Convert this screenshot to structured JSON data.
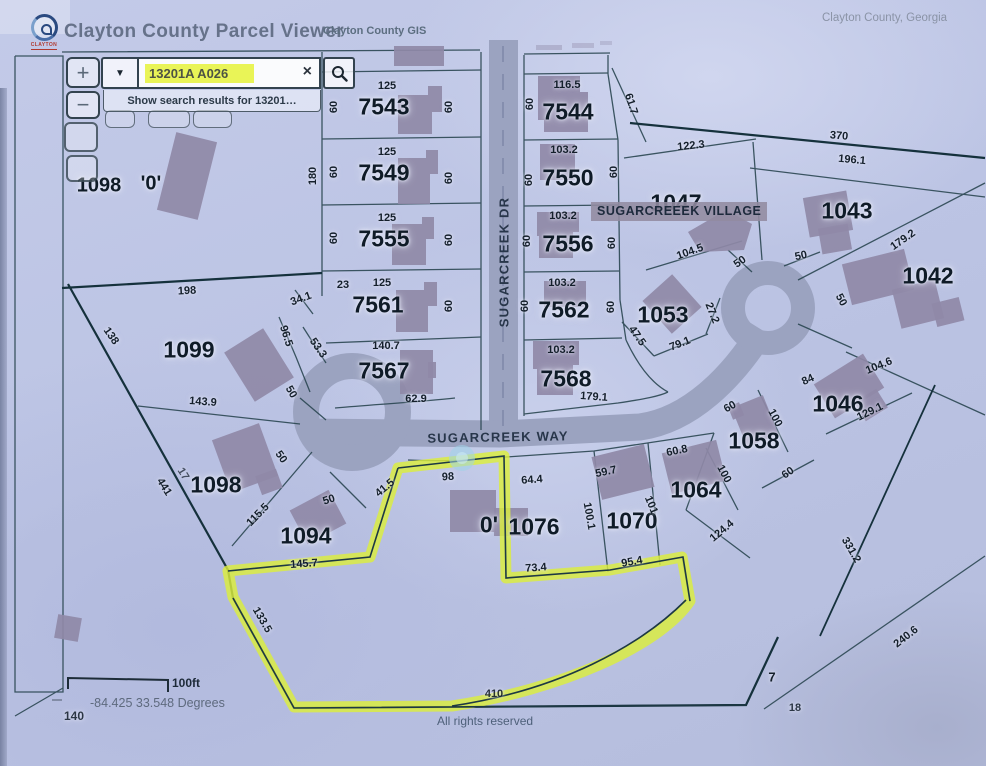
{
  "window": {
    "region": "Clayton County, Georgia"
  },
  "header": {
    "title": "Clayton County Parcel Viewer",
    "gis_label": "Clayton County GIS",
    "logo": "CLAYTON"
  },
  "search": {
    "value": "13201A A026",
    "suggestion": "Show search results for 13201…",
    "dropdown_icon": "▼",
    "clear_icon": "×"
  },
  "zoom": {
    "in": "+",
    "out": "−"
  },
  "map": {
    "subdivision_label": "SUGARCREEEK VILLAGE",
    "scale_label": "100ft",
    "coordinates": "-84.425 33.548 Degrees",
    "attribution": "All rights reserved",
    "highlight_color": "#dcee3c",
    "search_highlight_color": "#e9f457",
    "streets": [
      {
        "t": "SUGARCREEK DR",
        "x": 504,
        "y": 262,
        "r": -90
      },
      {
        "t": "SUGARCREEK WAY",
        "x": 498,
        "y": 437,
        "r": -1
      }
    ],
    "parcels": [
      {
        "t": "7543",
        "x": 384,
        "y": 107
      },
      {
        "t": "7549",
        "x": 384,
        "y": 173
      },
      {
        "t": "7555",
        "x": 384,
        "y": 239
      },
      {
        "t": "7561",
        "x": 378,
        "y": 305
      },
      {
        "t": "7567",
        "x": 384,
        "y": 371
      },
      {
        "t": "7544",
        "x": 568,
        "y": 112
      },
      {
        "t": "7550",
        "x": 568,
        "y": 178
      },
      {
        "t": "7556",
        "x": 568,
        "y": 244
      },
      {
        "t": "7562",
        "x": 564,
        "y": 310
      },
      {
        "t": "7568",
        "x": 566,
        "y": 379
      },
      {
        "t": "1047",
        "x": 676,
        "y": 203
      },
      {
        "t": "1043",
        "x": 847,
        "y": 211
      },
      {
        "t": "1042",
        "x": 928,
        "y": 276
      },
      {
        "t": "1053",
        "x": 663,
        "y": 315
      },
      {
        "t": "1046",
        "x": 838,
        "y": 404
      },
      {
        "t": "1058",
        "x": 754,
        "y": 441
      },
      {
        "t": "1064",
        "x": 696,
        "y": 490
      },
      {
        "t": "1070",
        "x": 632,
        "y": 521
      },
      {
        "t": "1076",
        "x": 534,
        "y": 527
      },
      {
        "t": "0'",
        "x": 489,
        "y": 525
      },
      {
        "t": "1094",
        "x": 306,
        "y": 536
      },
      {
        "t": "1098",
        "x": 216,
        "y": 485
      },
      {
        "t": "1099",
        "x": 189,
        "y": 350
      },
      {
        "t": "1098",
        "x": 99,
        "y": 186,
        "s": 20
      },
      {
        "t": "'0'",
        "x": 151,
        "y": 184,
        "s": 20
      }
    ],
    "dimensions": [
      {
        "t": "125",
        "x": 387,
        "y": 86
      },
      {
        "t": "60",
        "x": 334,
        "y": 107,
        "r": -90
      },
      {
        "t": "60",
        "x": 449,
        "y": 107,
        "r": -90
      },
      {
        "t": "125",
        "x": 387,
        "y": 152
      },
      {
        "t": "60",
        "x": 334,
        "y": 172,
        "r": -90
      },
      {
        "t": "60",
        "x": 449,
        "y": 178,
        "r": -90
      },
      {
        "t": "180",
        "x": 313,
        "y": 176,
        "r": -90
      },
      {
        "t": "125",
        "x": 387,
        "y": 218
      },
      {
        "t": "60",
        "x": 334,
        "y": 238,
        "r": -90
      },
      {
        "t": "60",
        "x": 449,
        "y": 240,
        "r": -90
      },
      {
        "t": "125",
        "x": 382,
        "y": 283
      },
      {
        "t": "23",
        "x": 343,
        "y": 285
      },
      {
        "t": "60",
        "x": 449,
        "y": 306,
        "r": -90
      },
      {
        "t": "34.1",
        "x": 301,
        "y": 299,
        "r": -20
      },
      {
        "t": "140.7",
        "x": 386,
        "y": 346
      },
      {
        "t": "96.5",
        "x": 286,
        "y": 336,
        "r": 72
      },
      {
        "t": "53.3",
        "x": 318,
        "y": 348,
        "r": 55
      },
      {
        "t": "62.9",
        "x": 416,
        "y": 399
      },
      {
        "t": "198",
        "x": 187,
        "y": 291,
        "r": -3
      },
      {
        "t": "138",
        "x": 111,
        "y": 336,
        "r": 55
      },
      {
        "t": "143.9",
        "x": 203,
        "y": 402,
        "r": 4
      },
      {
        "t": "116.5",
        "x": 567,
        "y": 85
      },
      {
        "t": "60",
        "x": 530,
        "y": 104,
        "r": -90
      },
      {
        "t": "61.7",
        "x": 631,
        "y": 104,
        "r": 72
      },
      {
        "t": "103.2",
        "x": 564,
        "y": 150
      },
      {
        "t": "60",
        "x": 529,
        "y": 180,
        "r": -90
      },
      {
        "t": "60",
        "x": 614,
        "y": 172,
        "r": -90
      },
      {
        "t": "122.3",
        "x": 691,
        "y": 146,
        "r": -6
      },
      {
        "t": "103.2",
        "x": 563,
        "y": 216
      },
      {
        "t": "60",
        "x": 527,
        "y": 241,
        "r": -90
      },
      {
        "t": "60",
        "x": 612,
        "y": 243,
        "r": -90
      },
      {
        "t": "103.2",
        "x": 562,
        "y": 283
      },
      {
        "t": "60",
        "x": 525,
        "y": 306,
        "r": -90
      },
      {
        "t": "60",
        "x": 611,
        "y": 307,
        "r": -90
      },
      {
        "t": "103.2",
        "x": 561,
        "y": 350
      },
      {
        "t": "179.1",
        "x": 594,
        "y": 397,
        "r": 4
      },
      {
        "t": "47.5",
        "x": 637,
        "y": 336,
        "r": 55
      },
      {
        "t": "79.1",
        "x": 680,
        "y": 344,
        "r": -22
      },
      {
        "t": "27.2",
        "x": 712,
        "y": 313,
        "r": 68
      },
      {
        "t": "370",
        "x": 839,
        "y": 136,
        "r": 5
      },
      {
        "t": "196.1",
        "x": 852,
        "y": 160,
        "r": 5
      },
      {
        "t": "104.5",
        "x": 690,
        "y": 252,
        "r": -20
      },
      {
        "t": "50",
        "x": 740,
        "y": 262,
        "r": -35
      },
      {
        "t": "50",
        "x": 801,
        "y": 256,
        "r": -12
      },
      {
        "t": "179.2",
        "x": 903,
        "y": 240,
        "r": -35
      },
      {
        "t": "50",
        "x": 841,
        "y": 300,
        "r": 62
      },
      {
        "t": "104.6",
        "x": 879,
        "y": 366,
        "r": -22
      },
      {
        "t": "84",
        "x": 808,
        "y": 380,
        "r": -25
      },
      {
        "t": "129.1",
        "x": 870,
        "y": 412,
        "r": -26
      },
      {
        "t": "100",
        "x": 775,
        "y": 418,
        "r": 62
      },
      {
        "t": "60",
        "x": 730,
        "y": 407,
        "r": -30
      },
      {
        "t": "60.8",
        "x": 677,
        "y": 451,
        "r": -12
      },
      {
        "t": "100",
        "x": 724,
        "y": 474,
        "r": 62
      },
      {
        "t": "60",
        "x": 788,
        "y": 473,
        "r": -35
      },
      {
        "t": "59.7",
        "x": 606,
        "y": 472,
        "r": -12
      },
      {
        "t": "101",
        "x": 651,
        "y": 505,
        "r": 68
      },
      {
        "t": "124.4",
        "x": 722,
        "y": 531,
        "r": -40
      },
      {
        "t": "100.1",
        "x": 589,
        "y": 516,
        "r": 80
      },
      {
        "t": "95.4",
        "x": 632,
        "y": 562,
        "r": -10
      },
      {
        "t": "73.4",
        "x": 536,
        "y": 568,
        "r": -4
      },
      {
        "t": "64.4",
        "x": 532,
        "y": 480,
        "r": -4
      },
      {
        "t": "98",
        "x": 448,
        "y": 477,
        "r": -3
      },
      {
        "t": "41.5",
        "x": 385,
        "y": 488,
        "r": -40
      },
      {
        "t": "115.5",
        "x": 258,
        "y": 515,
        "r": -46
      },
      {
        "t": "50",
        "x": 329,
        "y": 500,
        "r": -18
      },
      {
        "t": "50",
        "x": 281,
        "y": 457,
        "r": 55
      },
      {
        "t": "145.7",
        "x": 304,
        "y": 564,
        "r": -4
      },
      {
        "t": "441",
        "x": 164,
        "y": 487,
        "r": 58
      },
      {
        "t": "17",
        "x": 183,
        "y": 474,
        "r": 58,
        "o": 0.7
      },
      {
        "t": "50",
        "x": 291,
        "y": 392,
        "r": 60
      },
      {
        "t": "133.5",
        "x": 262,
        "y": 620,
        "r": 60
      },
      {
        "t": "240.6",
        "x": 906,
        "y": 637,
        "r": -38
      },
      {
        "t": "331.2",
        "x": 851,
        "y": 550,
        "r": 60
      },
      {
        "t": "7",
        "x": 772,
        "y": 677,
        "s": 13
      },
      {
        "t": "18",
        "x": 795,
        "y": 708,
        "o": 0.85
      },
      {
        "t": "410",
        "x": 494,
        "y": 694,
        "o": 0.9
      },
      {
        "t": "140",
        "x": 74,
        "y": 716,
        "s": 12,
        "o": 0.85
      }
    ]
  }
}
